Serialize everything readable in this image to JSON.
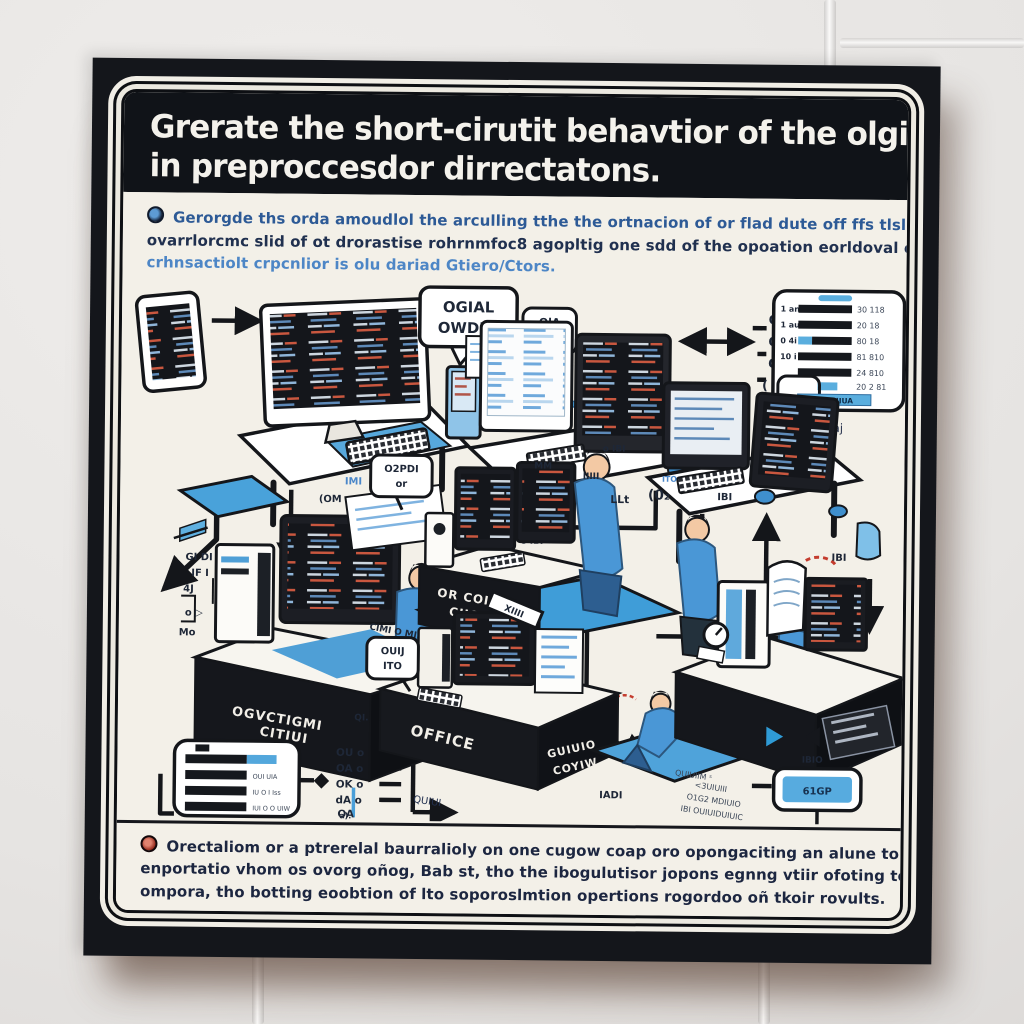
{
  "poster": {
    "title_line1": "Grerate the  short-cirutit behavtior of the olgial",
    "title_line2": "in preproccesdor dirrectatons.",
    "top_paragraph": {
      "lines": [
        "Gerorgde ths orda amoudlol the arculling tthe the ortnacion of or flad dute off ffs tlsl the orpting",
        "ovarrlorcmc slid of ot drorastise rohrnmfoc8  agopltig one sdd of the opoation eorldoval onmation",
        "crhnsactiolt crpcnlior is olu dariad Gtiero/Ctors."
      ]
    },
    "bottom_paragraph": {
      "lines": [
        "Orectaliom or a ptrerelal baurralioly on one cugow coap oro opongaciting an  alune  to oollde",
        "enportatio vhom os ovorg oñog, Bab st, tho the ibogulutisor jopons egnng vtiir  ofoting to eoatlical",
        "ompora,   tho botting eoobtion of lto soporoslmtion opertions rogordoo oñ tkoir rovults."
      ]
    }
  },
  "scene": {
    "bubble_model": [
      "OGIAL",
      "OWDEL"
    ],
    "bubble_small": [
      "OlA",
      "OUR"
    ],
    "io_list": [
      "ON",
      "OU o",
      "OU o",
      "( OU ro",
      "OU oo"
    ],
    "panel": {
      "rows": [
        {
          "l": "1 an",
          "r": "30 118"
        },
        {
          "l": "1 au",
          "r": "20 18"
        },
        {
          "l": "0 4i",
          "r": "80 18"
        },
        {
          "l": "10 i",
          "r": "81 810"
        },
        {
          "l": "",
          "r": "24 810"
        },
        {
          "l": "",
          "r": "20 2 81"
        }
      ],
      "footer": "PBNUIUA",
      "caption": "LNaj"
    },
    "flags": [
      "GI DI",
      "IF I",
      "4J",
      "o ▷",
      "Mo"
    ],
    "pedestal_left": [
      "OGVCTIGMI",
      "CITIUI"
    ],
    "pedestal_left_caption": "QUIUIC",
    "bubble_opin": [
      "O2PDI",
      "or"
    ],
    "label_or": "or",
    "label_imi": "IMI",
    "label_om": "(OM",
    "label_oibi_top": "o IBI",
    "pedestal_center": [
      "OR COL",
      "CUQOQ-"
    ],
    "center_labels": [
      "CIMI O MIMBE",
      "(1)",
      "OUIII"
    ],
    "bubble_ouij": [
      "OUIJ",
      "ITO"
    ],
    "ribbon_tag": "XIIII",
    "office": "OFFICE",
    "office_side": [
      "GUIUIO",
      "COYIW"
    ],
    "office_caption": "QUIUI",
    "checklist_side": [
      "OUI UIA",
      "IU O I Iss",
      "IUI O O UIW"
    ],
    "branch_list": [
      "OU o",
      "OA o",
      "OK o",
      "dA o",
      "OA",
      "a)."
    ],
    "squiggle": "(IIIIIIII",
    "label_162": "(162",
    "label_qi": "QI.",
    "mid_labels": {
      "oibi": "o IBI",
      "iiiii": "IIIII",
      "llt": "LLt",
      "co2": "(0₂",
      "ito": "ITO",
      "ibi": "IBI",
      "mm": "MM",
      "ibi2": "IBI",
      "ito2": "ITO",
      "ope": "OPE",
      "iadi": "IADI",
      "ibio": "IBIO"
    },
    "bottom_text": [
      "QUIUIIM ˢ",
      "<3UIUIII",
      "O1G2 MDIUIO",
      "IBI OUIUIDUIUIC"
    ],
    "button": "61GP"
  },
  "colors": {
    "accent_blue": "#4b9fd8",
    "navy": "#20304f",
    "ink": "#14161b",
    "cream": "#f3f0e8",
    "red": "#c03a2b"
  }
}
